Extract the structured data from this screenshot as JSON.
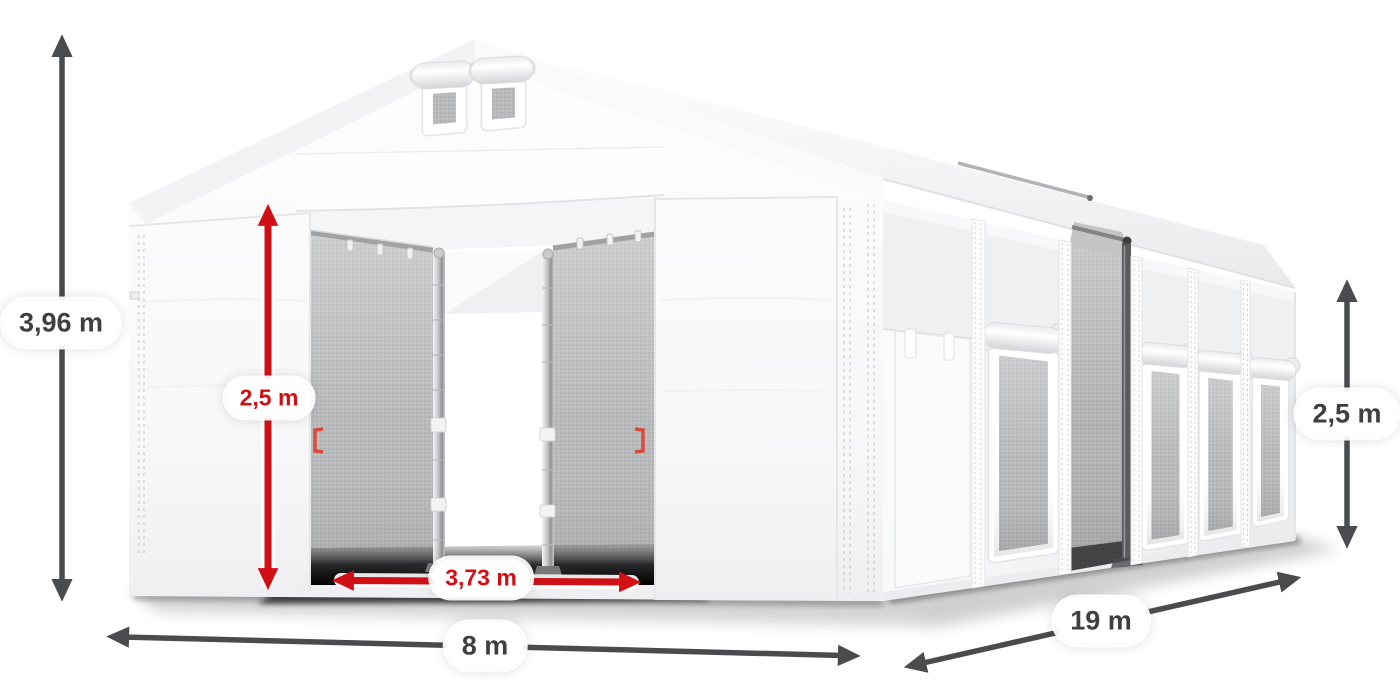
{
  "colors": {
    "dimension_dark": "#4a4b4d",
    "dimension_red": "#d11016",
    "label_text_dark": "#3e3f41",
    "label_background": "#ffffff",
    "tent_white": "#ffffff",
    "tent_shading": "#ececee",
    "interior_gray": "#b9babc"
  },
  "dimensions": {
    "total_height": {
      "label": "3,96 m",
      "style": "dark"
    },
    "door_height": {
      "label": "2,5 m",
      "style": "red"
    },
    "door_width": {
      "label": "3,73 m",
      "style": "red"
    },
    "front_width": {
      "label": "8 m",
      "style": "dark"
    },
    "side_length": {
      "label": "19 m",
      "style": "dark"
    },
    "side_wall_height": {
      "label": "2,5 m",
      "style": "dark"
    }
  }
}
